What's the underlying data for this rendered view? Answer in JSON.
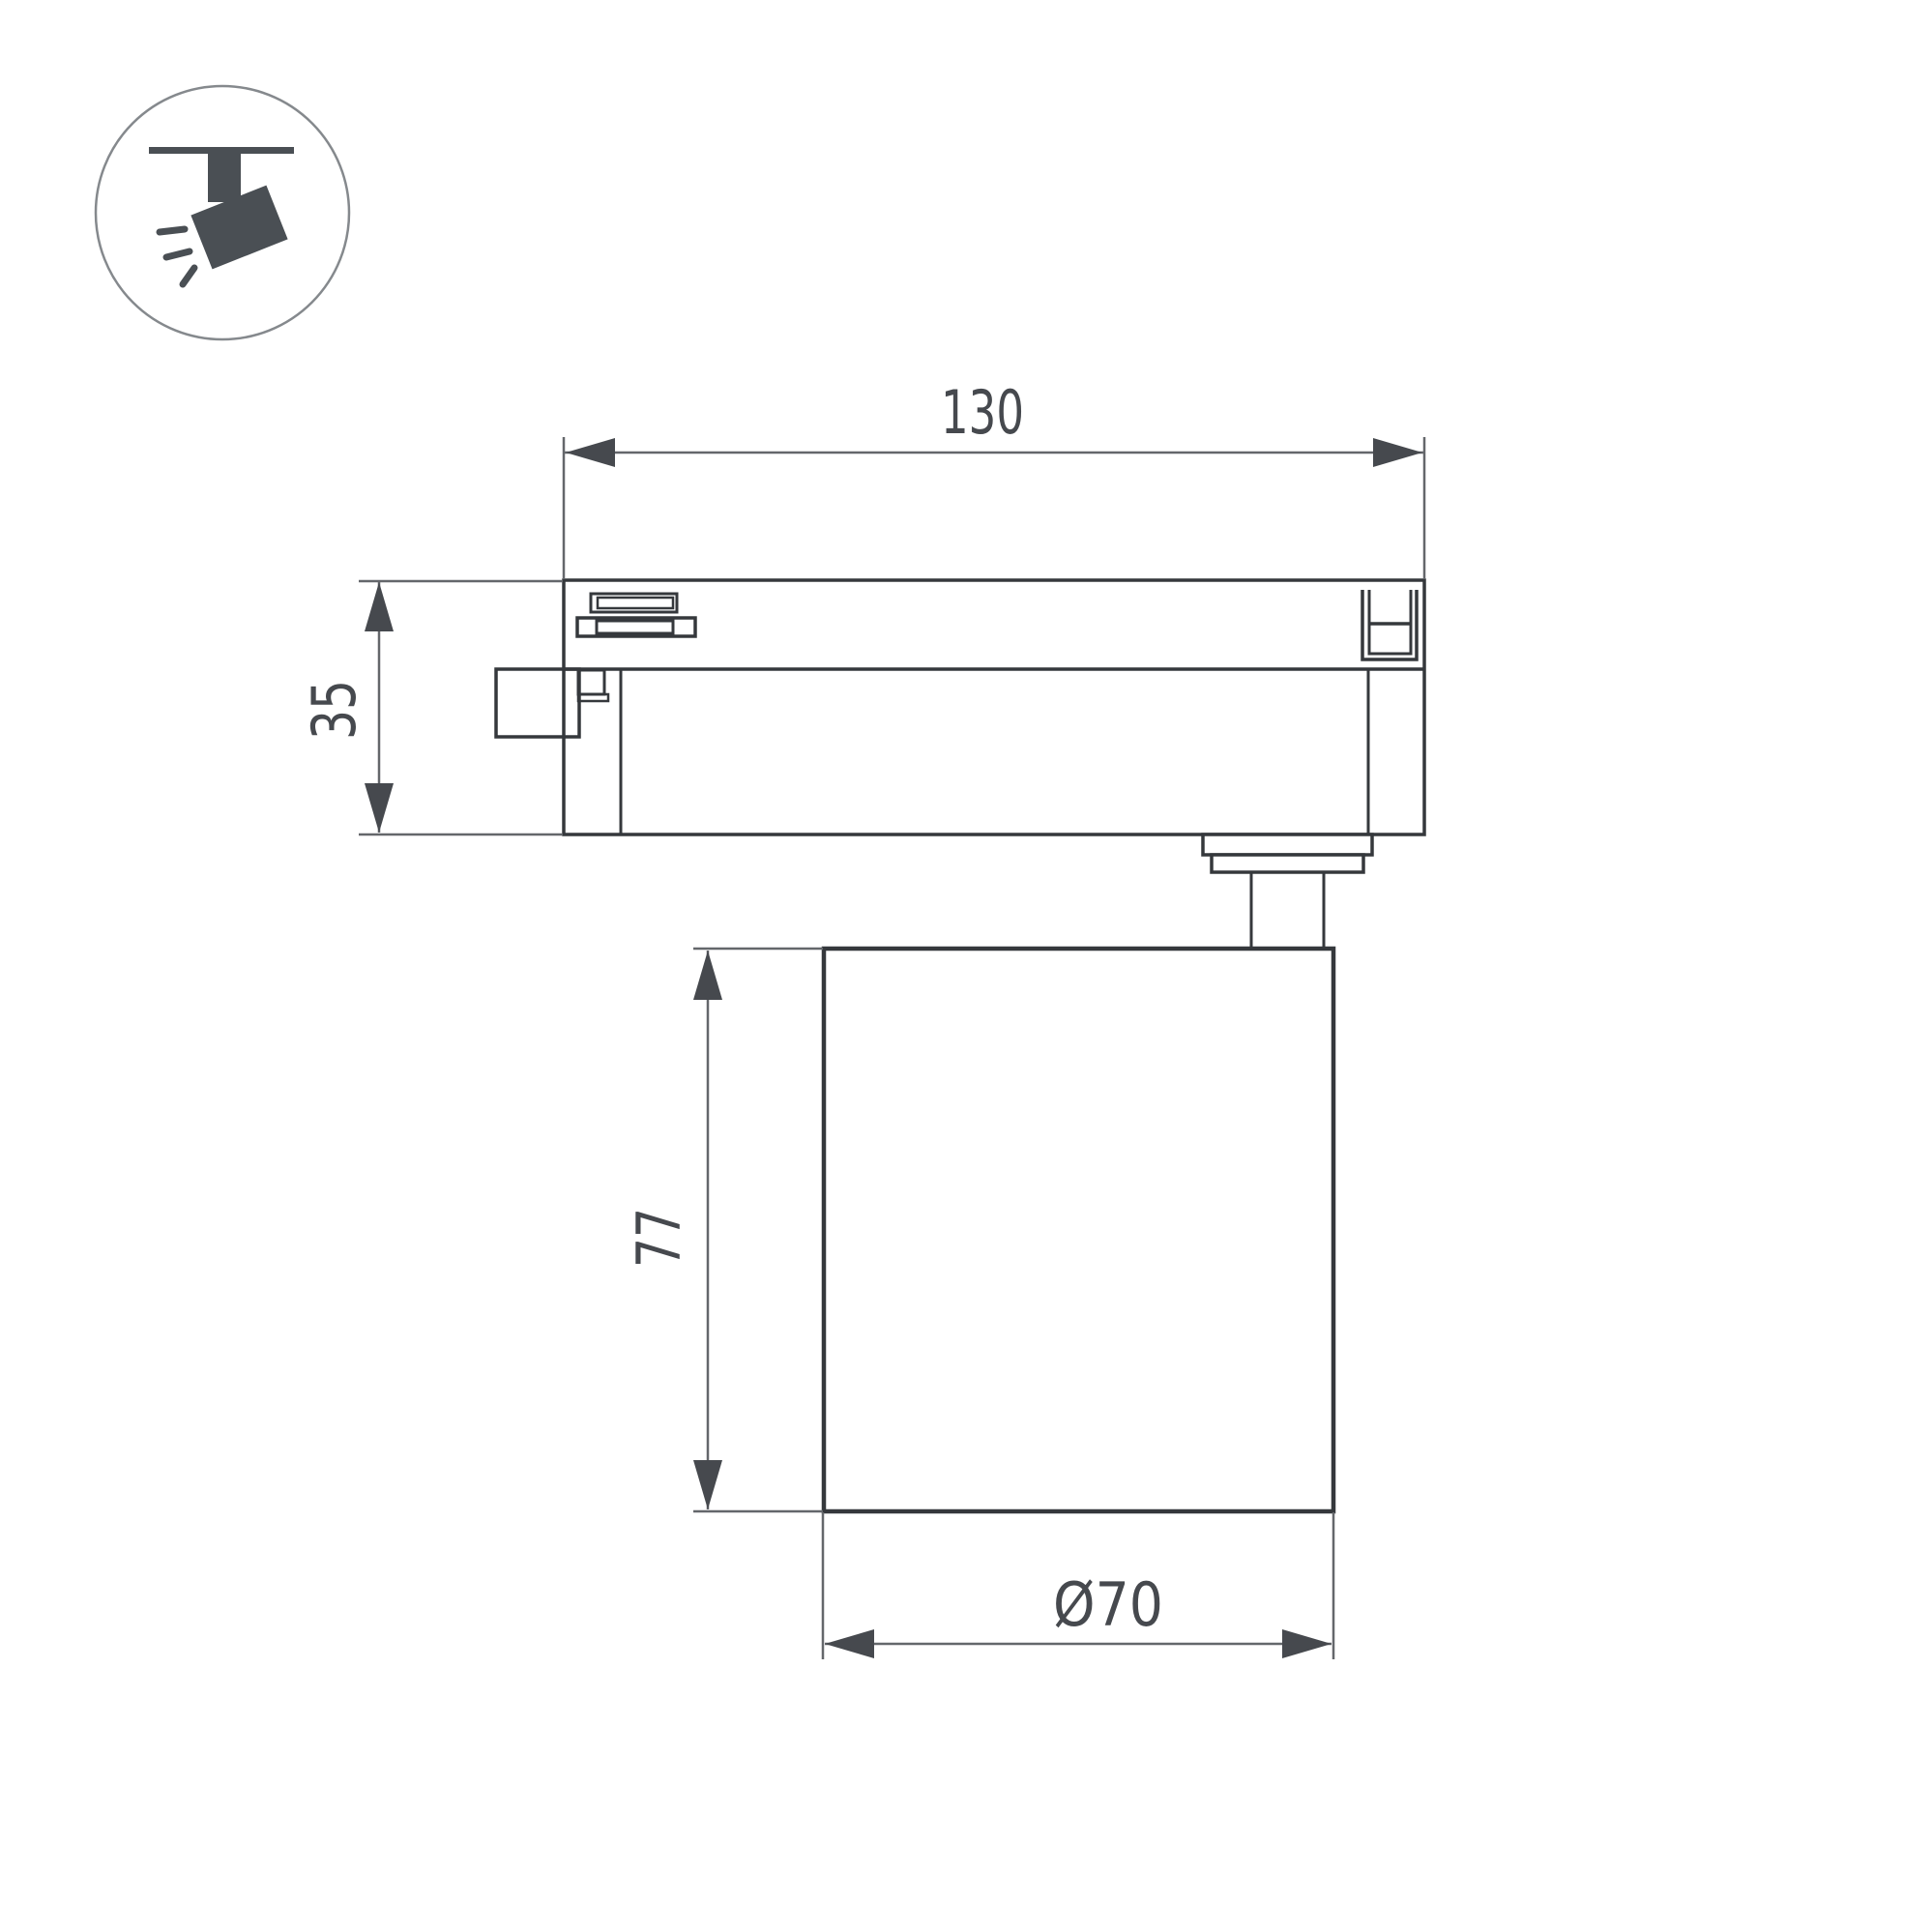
{
  "drawing": {
    "dim_width": "130",
    "dim_track_height": "35",
    "dim_body_height": "77",
    "dim_diameter": "Ø70"
  },
  "icon": {
    "name": "track-spotlight"
  },
  "colors": {
    "outline": "#35383c",
    "dim_line": "#64676b",
    "dim_text": "#46494e",
    "icon_fill": "#4a4f54",
    "icon_circle_stroke": "#85898d",
    "background": "#ffffff"
  }
}
